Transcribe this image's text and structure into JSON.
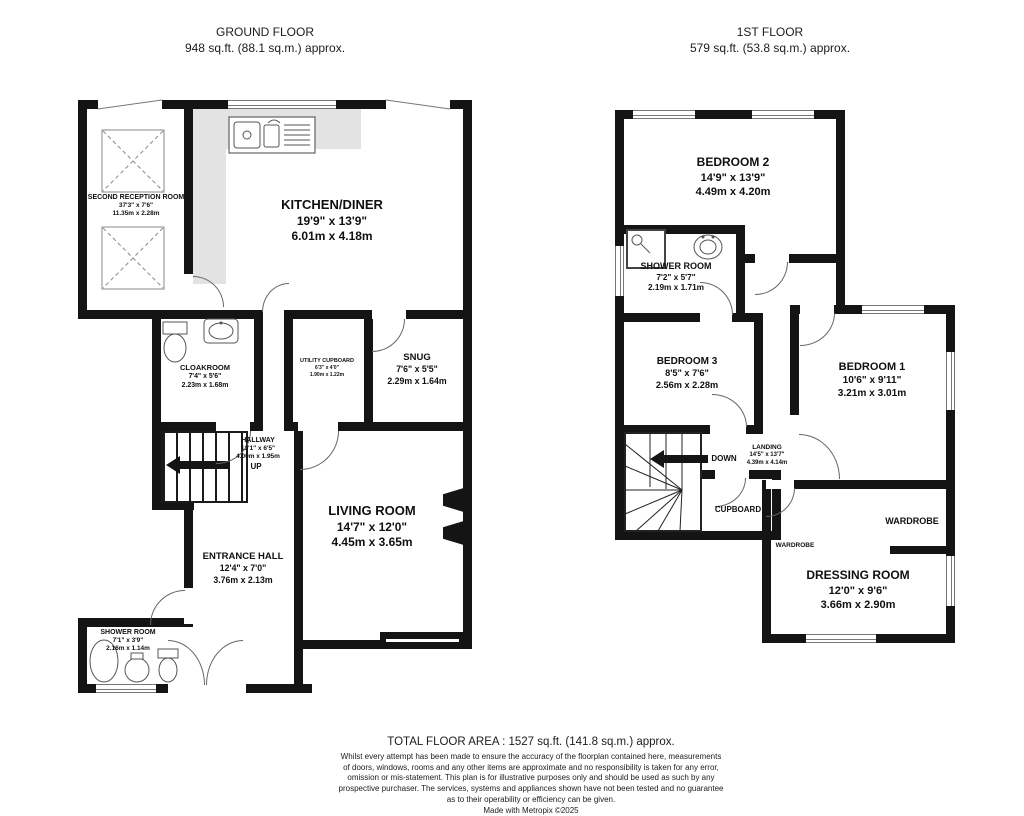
{
  "colors": {
    "wall": "#141414",
    "counter": "#e3e3e3",
    "text": "#101010"
  },
  "ground_floor": {
    "title": "GROUND FLOOR",
    "area": "948 sq.ft. (88.1 sq.m.) approx.",
    "rooms": {
      "second_reception": {
        "name": "SECOND RECEPTION ROOM",
        "imperial": "37'3\" x 7'6\"",
        "metric": "11.35m x 2.28m"
      },
      "kitchen_diner": {
        "name": "KITCHEN/DINER",
        "imperial": "19'9\" x 13'9\"",
        "metric": "6.01m x 4.18m"
      },
      "cloakroom": {
        "name": "CLOAKROOM",
        "imperial": "7'4\" x 5'6\"",
        "metric": "2.23m x 1.68m"
      },
      "utility_cupboard": {
        "name": "UTILITY CUPBOARD",
        "imperial": "6'3\" x 4'0\"",
        "metric": "1.90m x 1.22m"
      },
      "snug": {
        "name": "SNUG",
        "imperial": "7'6\" x 5'5\"",
        "metric": "2.29m x 1.64m"
      },
      "hallway": {
        "name": "HALLWAY",
        "imperial": "13'1\" x 6'5\"",
        "metric": "4.00m x 1.95m"
      },
      "living_room": {
        "name": "LIVING ROOM",
        "imperial": "14'7\" x 12'0\"",
        "metric": "4.45m x 3.65m"
      },
      "entrance_hall": {
        "name": "ENTRANCE HALL",
        "imperial": "12'4\" x 7'0\"",
        "metric": "3.76m x 2.13m"
      },
      "shower_room": {
        "name": "SHOWER ROOM",
        "imperial": "7'1\" x 3'9\"",
        "metric": "2.16m x 1.14m"
      }
    },
    "labels": {
      "up": "UP"
    }
  },
  "first_floor": {
    "title": "1ST FLOOR",
    "area": "579 sq.ft. (53.8 sq.m.) approx.",
    "rooms": {
      "bedroom_2": {
        "name": "BEDROOM 2",
        "imperial": "14'9\" x 13'9\"",
        "metric": "4.49m x 4.20m"
      },
      "shower_room": {
        "name": "SHOWER ROOM",
        "imperial": "7'2\" x 5'7\"",
        "metric": "2.19m x 1.71m"
      },
      "bedroom_3": {
        "name": "BEDROOM 3",
        "imperial": "8'5\" x 7'6\"",
        "metric": "2.56m x 2.28m"
      },
      "bedroom_1": {
        "name": "BEDROOM 1",
        "imperial": "10'6\" x 9'11\"",
        "metric": "3.21m x 3.01m"
      },
      "landing": {
        "name": "LANDING",
        "imperial": "14'5\" x 13'7\"",
        "metric": "4.39m x 4.14m"
      },
      "dressing_room": {
        "name": "DRESSING ROOM",
        "imperial": "12'0\" x 9'6\"",
        "metric": "3.66m x 2.90m"
      }
    },
    "labels": {
      "down": "DOWN",
      "cupboard": "CUPBOARD",
      "wardrobe_right": "WARDROBE",
      "wardrobe_left": "WARDROBE"
    }
  },
  "footer": {
    "total_area": "TOTAL FLOOR AREA : 1527 sq.ft. (141.8 sq.m.) approx.",
    "disclaimer_lines": [
      "Whilst every attempt has been made to ensure the accuracy of the floorplan contained here, measurements",
      "of doors, windows, rooms and any other items are approximate and no responsibility is taken for any error,",
      "omission or mis-statement. This plan is for illustrative purposes only and should be used as such by any",
      "prospective purchaser. The services, systems and appliances shown have not been tested and no guarantee",
      "as to their operability or efficiency can be given."
    ],
    "credit": "Made with Metropix ©2025"
  }
}
